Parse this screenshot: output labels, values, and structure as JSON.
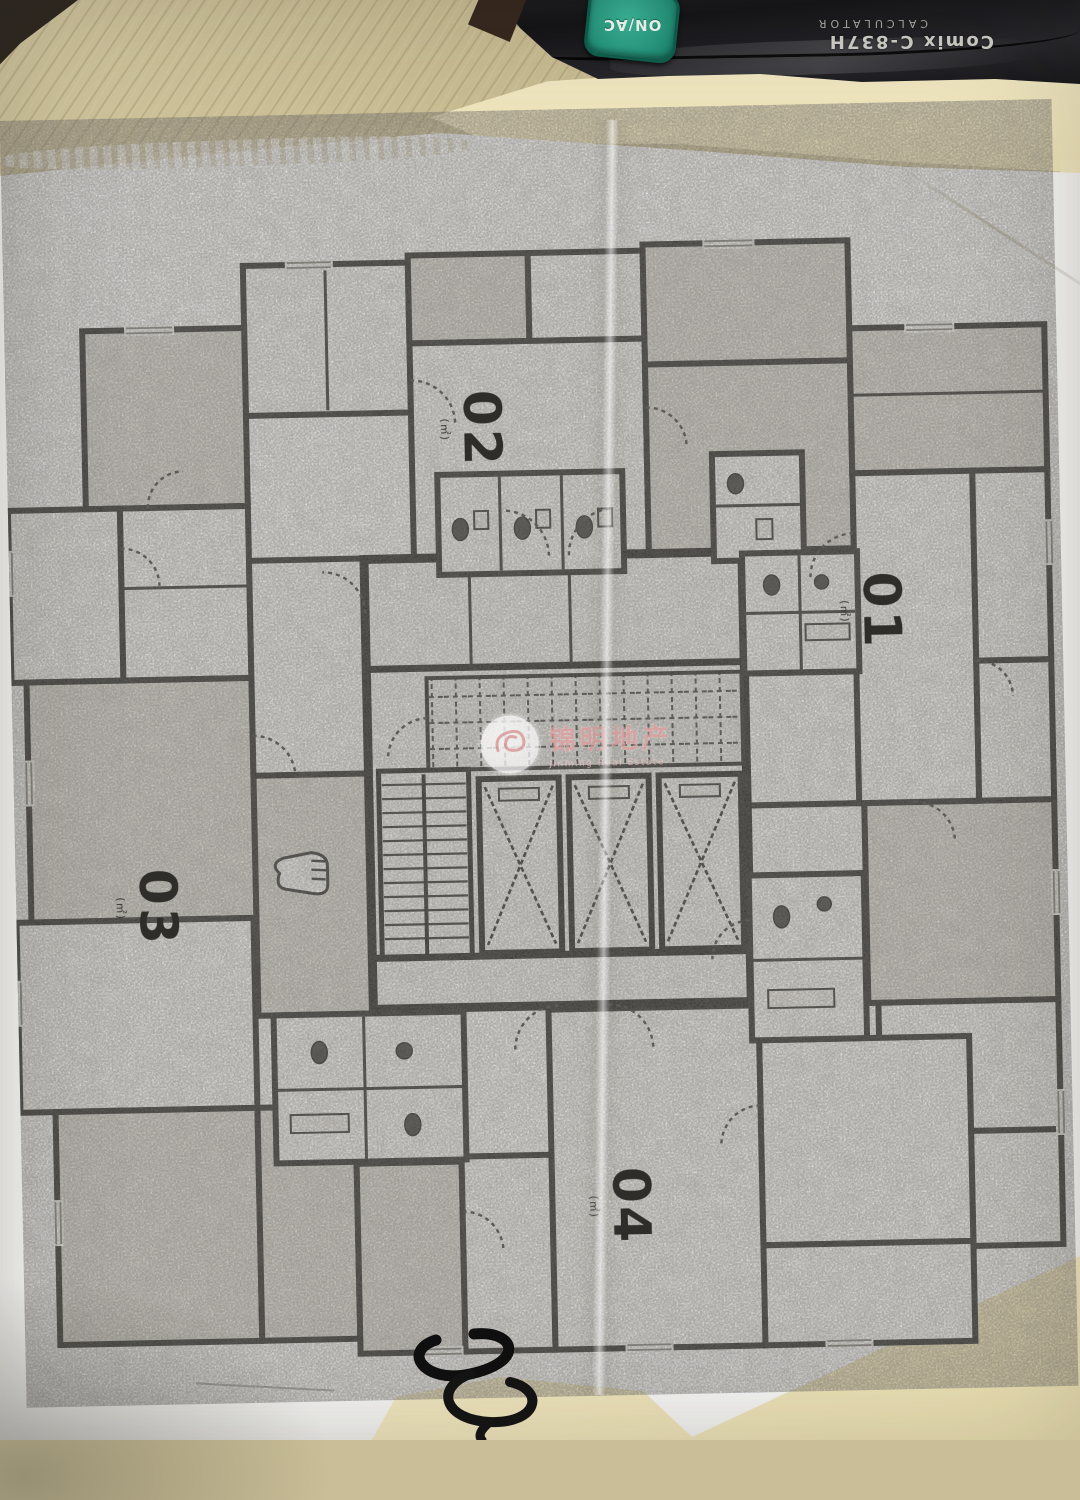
{
  "calculator": {
    "brand": "Comix",
    "model": "C-837H",
    "label": "CALCULATOR",
    "onac_key": "ON/AC"
  },
  "floor_plan": {
    "units": [
      {
        "id": "02",
        "area_note": "(㎡)"
      },
      {
        "id": "01",
        "area_note": "(㎡)"
      },
      {
        "id": "03",
        "area_note": "(㎡)"
      },
      {
        "id": "04",
        "area_note": "(㎡)"
      }
    ],
    "watermark": {
      "cn": "锦明地产",
      "en": "Jinming Real Estate"
    }
  },
  "icons": {
    "elevator": "crossed-box",
    "staircase": "tread-lines",
    "door": "quarter-arc",
    "hand_marker": "fist-shape",
    "watermark_logo": "swirl-circle",
    "spiral_binding": "wire-coil"
  },
  "colors": {
    "desk": "#c9be97",
    "paper_white": "#f5f5f3",
    "paper_cream": "#ede4bd",
    "calculator_black": "#1d1d20",
    "key_green": "#2fa98d",
    "plan_ink": "#34332f",
    "toner_gray": "#d9d6cf",
    "watermark_pink": "#dc9f9f"
  }
}
